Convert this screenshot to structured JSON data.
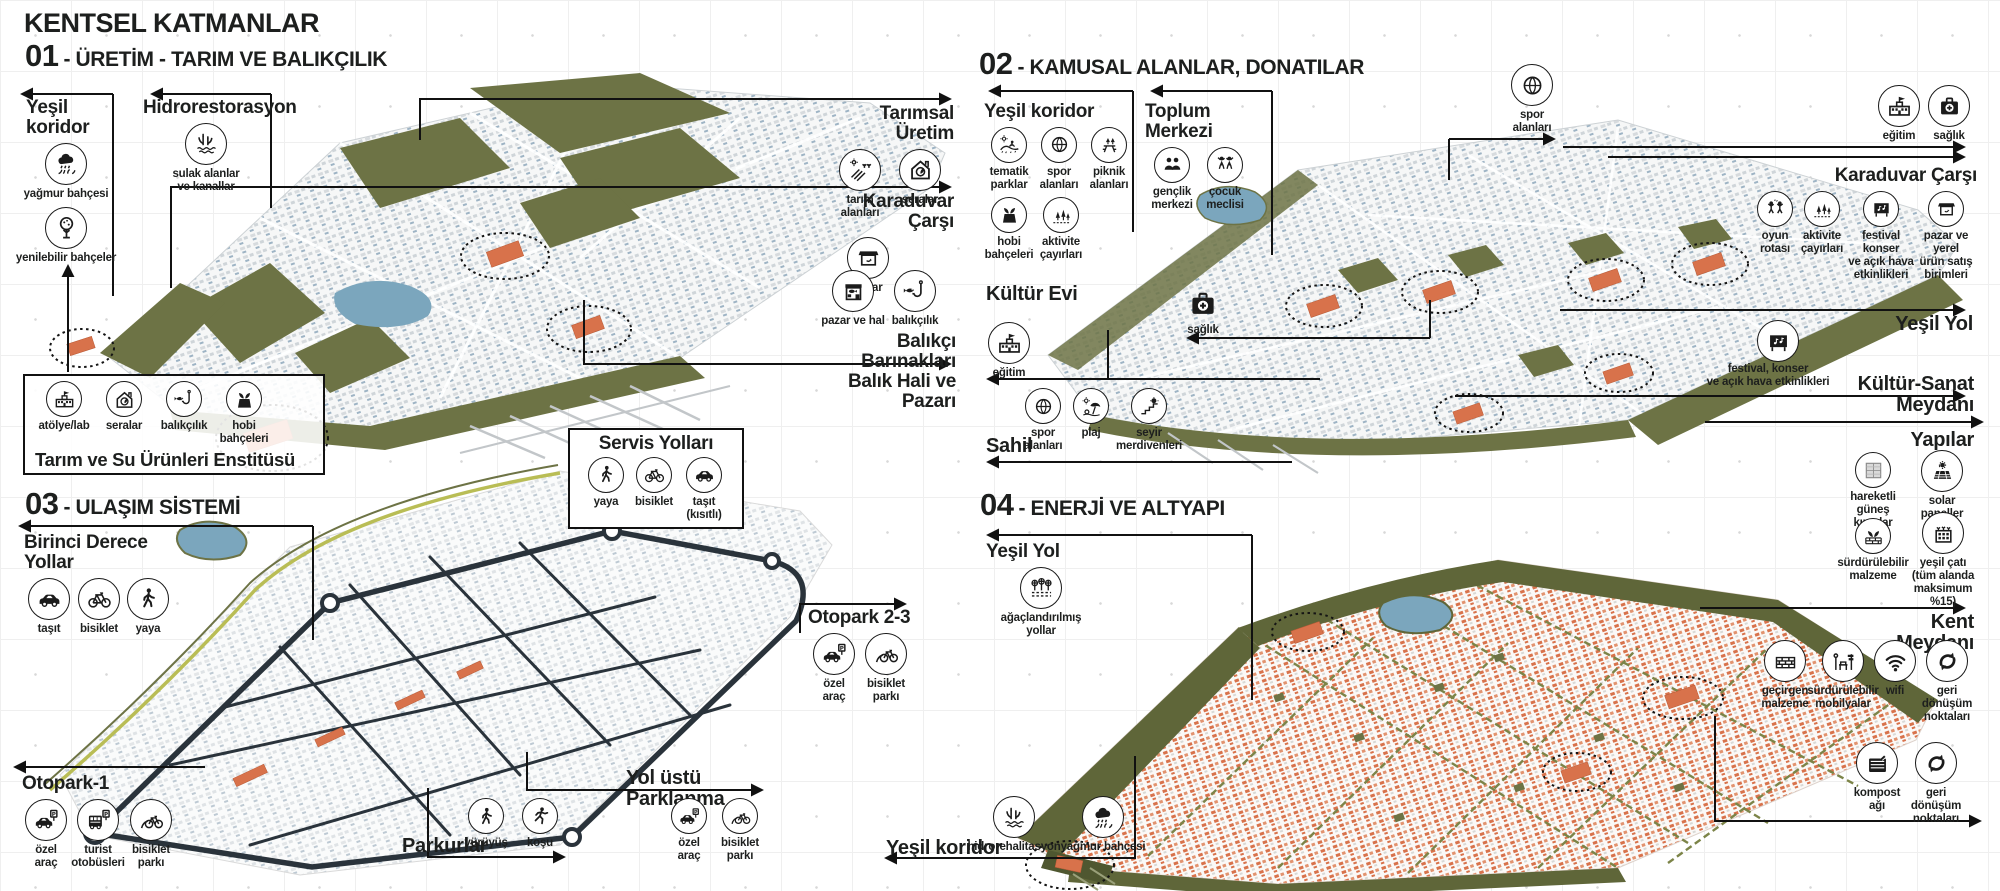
{
  "page": {
    "title": "KENTSEL KATMANLAR"
  },
  "colors": {
    "ink": "#1d1f1e",
    "olive": "#6d7345",
    "olive_dark": "#5f6639",
    "lake": "#7ba6bd",
    "orange": "#d8724b",
    "road": "#2a333b",
    "coast_line": "#b9bd55"
  },
  "q1": {
    "num": "01",
    "title": "- ÜRETİM - TARIM VE BALIKÇILIK",
    "yesil_koridor": {
      "title": "Yeşil koridor",
      "items": [
        {
          "icon": "rain-garden",
          "label": "yağmur bahçesi"
        },
        {
          "icon": "edible-gardens",
          "label": "yenilebilir bahçeler"
        }
      ]
    },
    "hidrorestorasyon": {
      "title": "Hidrorestorasyon",
      "items": [
        {
          "icon": "wetlands-canals",
          "label": "sulak alanlar\nve kanallar"
        }
      ]
    },
    "tarimsal_uretim": {
      "title": "Tarımsal Üretim",
      "items": [
        {
          "icon": "farm-fields",
          "label": "tarım alanları"
        },
        {
          "icon": "greenhouse",
          "label": "seralar"
        }
      ]
    },
    "karaduvar_carsi": {
      "title": "Karaduvar Çarşı",
      "items": [
        {
          "icon": "market",
          "label": "pazar"
        }
      ]
    },
    "balikci": {
      "title": "Balıkçı Barınakları\nBalık Hali ve Pazarı",
      "items": [
        {
          "icon": "fish-market",
          "label": "pazar ve hal"
        },
        {
          "icon": "fishing",
          "label": "balıkçılık"
        }
      ]
    },
    "enstitu": {
      "title": "Tarım ve Su Ürünleri Enstitüsü",
      "items": [
        {
          "icon": "school",
          "label": "atölye/lab"
        },
        {
          "icon": "greenhouse",
          "label": "seralar"
        },
        {
          "icon": "fishing",
          "label": "balıkçılık"
        },
        {
          "icon": "hobby-gardens",
          "label": "hobi\nbahçeleri"
        }
      ]
    }
  },
  "q2": {
    "num": "02",
    "title": "- KAMUSAL ALANLAR, DONATILAR",
    "yesil_koridor": {
      "title": "Yeşil koridor",
      "items": [
        {
          "icon": "thematic-parks",
          "label": "tematik\nparklar"
        },
        {
          "icon": "sports",
          "label": "spor\nalanları"
        },
        {
          "icon": "picnic",
          "label": "piknik\nalanları"
        },
        {
          "icon": "hobby-gardens",
          "label": "hobi\nbahçeleri"
        },
        {
          "icon": "activity-meadows",
          "label": "aktivite\nçayırları"
        }
      ]
    },
    "toplum_merkezi": {
      "title": "Toplum Merkezi",
      "items": [
        {
          "icon": "youth-center",
          "label": "gençlik\nmerkezi"
        },
        {
          "icon": "children-assembly",
          "label": "çocuk\nmeclisi"
        }
      ]
    },
    "spor_ust": {
      "items": [
        {
          "icon": "sports",
          "label": "spor\nalanları"
        }
      ]
    },
    "donatilar_ust": {
      "items": [
        {
          "icon": "school",
          "label": "eğitim"
        },
        {
          "icon": "health",
          "label": "sağlık"
        }
      ]
    },
    "karaduvar_carsi": {
      "title": "Karaduvar Çarşı",
      "items": [
        {
          "icon": "play-route",
          "label": "oyun\nrotası"
        },
        {
          "icon": "activity-meadows",
          "label": "aktivite\nçayırları"
        },
        {
          "icon": "festival",
          "label": "festival konser\nve açık hava\netkinlikleri"
        },
        {
          "icon": "market",
          "label": "pazar ve yerel\nürün satış\nbirimleri"
        }
      ]
    },
    "kultur_evi": {
      "title": "Kültür Evi",
      "items": [
        {
          "icon": "school",
          "label": "eğitim"
        },
        {
          "icon": "health",
          "label": "sağlık"
        }
      ]
    },
    "sahil": {
      "title": "Sahil",
      "items": [
        {
          "icon": "sports",
          "label": "spor\nalanları"
        },
        {
          "icon": "beach",
          "label": "plaj"
        },
        {
          "icon": "viewing-stairs",
          "label": "seyir\nmerdivenleri"
        }
      ]
    },
    "yesil_yol": {
      "title": "Yeşil Yol"
    },
    "kultur_sanat": {
      "title": "Kültür-Sanat Meydanı",
      "items": [
        {
          "icon": "festival",
          "label": "festival, konser\nve açık hava etkinlikleri"
        }
      ]
    }
  },
  "q3": {
    "num": "03",
    "title": "- ULAŞIM SİSTEMİ",
    "birinci_derece": {
      "title": "Birinci Derece Yollar",
      "items": [
        {
          "icon": "car",
          "label": "taşıt"
        },
        {
          "icon": "bicycle",
          "label": "bisiklet"
        },
        {
          "icon": "pedestrian",
          "label": "yaya"
        }
      ]
    },
    "servis": {
      "title": "Servis Yolları",
      "items": [
        {
          "icon": "pedestrian",
          "label": "yaya"
        },
        {
          "icon": "bicycle",
          "label": "bisiklet"
        },
        {
          "icon": "car",
          "label": "taşıt\n(kısıtlı)"
        }
      ]
    },
    "otopark23": {
      "title": "Otopark 2-3",
      "items": [
        {
          "icon": "car-parking",
          "label": "özel\naraç"
        },
        {
          "icon": "bike-parking",
          "label": "bisiklet\nparkı"
        }
      ]
    },
    "otopark1": {
      "title": "Otopark-1",
      "items": [
        {
          "icon": "car-parking",
          "label": "özel\naraç"
        },
        {
          "icon": "bus-parking",
          "label": "turist\notobüsleri"
        },
        {
          "icon": "bike-parking",
          "label": "bisiklet\nparkı"
        }
      ]
    },
    "parkurlar": {
      "title": "Parkurlar",
      "items": [
        {
          "icon": "walking",
          "label": "yürüyüş"
        },
        {
          "icon": "running",
          "label": "koşu"
        }
      ]
    },
    "yolustu": {
      "title": "Yol üstü Parklanma",
      "items": [
        {
          "icon": "car-parking",
          "label": "özel\naraç"
        },
        {
          "icon": "bike-parking",
          "label": "bisiklet\nparkı"
        }
      ]
    }
  },
  "q4": {
    "num": "04",
    "title": "- ENERJİ VE ALTYAPI",
    "yesil_yol": {
      "title": "Yeşil Yol",
      "items": [
        {
          "icon": "tree-lined-roads",
          "label": "ağaçlandırılmış\nyollar"
        }
      ]
    },
    "yapilar": {
      "title": "Yapılar",
      "items": [
        {
          "icon": "sun-louvers",
          "label": "hareketli\ngüneş kırıcılar"
        },
        {
          "icon": "solar-panels",
          "label": "solar paneller"
        },
        {
          "icon": "sustainable-material",
          "label": "sürdürülebilir\nmalzeme"
        },
        {
          "icon": "green-roof",
          "label": "yeşil çatı\n(tüm alanda\nmaksimum %15)"
        }
      ]
    },
    "kent_meydani": {
      "title": "Kent Meydanı",
      "items": [
        {
          "icon": "permeable-material",
          "label": "geçirgen\nmalzeme"
        },
        {
          "icon": "sustainable-furniture",
          "label": "sürdürülebilir\nmobilyalar"
        },
        {
          "icon": "wifi",
          "label": "wifi"
        },
        {
          "icon": "recycling",
          "label": "geri dönüşüm\nnoktaları"
        }
      ]
    },
    "geri_donusum": {
      "items": [
        {
          "icon": "compost",
          "label": "kompost\nağı"
        },
        {
          "icon": "recycling",
          "label": "geri dönüşüm\nnoktaları"
        }
      ]
    },
    "yesil_koridor": {
      "title": "Yeşil koridor",
      "items": [
        {
          "icon": "wetlands-canals",
          "label": "hidrorehalitasyon"
        },
        {
          "icon": "rain-garden",
          "label": "yağmur bahçesi"
        }
      ]
    }
  }
}
